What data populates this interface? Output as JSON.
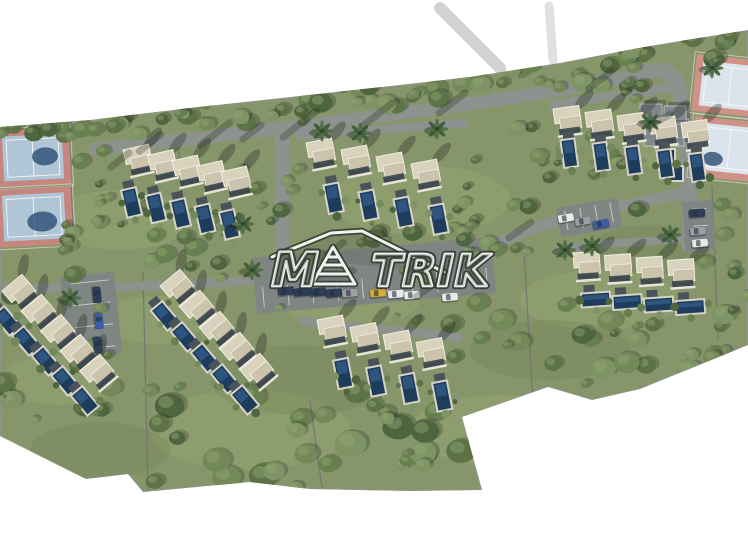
{
  "image": {
    "description": "Aerial 3D architectural rendering (site masterplan) of a residential villa development with private pools, access roads, parking areas and tennis courts, on white background",
    "background": "#ffffff",
    "width": 748,
    "height": 540
  },
  "watermark": {
    "text": "MATRIK",
    "style": "white outlined logo with roof line and striped pyramid as the letter A",
    "render": {
      "left": "M",
      "right": "TRIK"
    }
  },
  "summary": {
    "villas": 32,
    "pools": 34,
    "tennis_courts": 4,
    "parking_lots": 4,
    "cars": 18,
    "palm_trees": 11
  },
  "palette": {
    "grass": "#87966a",
    "grass_light": "#9aa976",
    "grass_dark": "#6e8052",
    "tree_greens": [
      "#5d7347",
      "#68804f",
      "#73895a",
      "#4f6540",
      "#7e9464"
    ],
    "tree_highlight": "#93a771",
    "road": "#8d928e",
    "parking": "#7f8582",
    "plot_line": "#70766e",
    "roof": "#d9d2bc",
    "roof_dark": "#cbc3ac",
    "roof_trim": "#f2efe3",
    "facade": "#39424b",
    "wall": "#e8e5d8",
    "pool": "#1e3c5c",
    "pool_light": "#35608c",
    "deck": "#d7d3c6",
    "patio": "#4a525a",
    "shadow": "rgba(30,38,32,0.32)",
    "tennis_border_west": "#c5867d",
    "tennis_surface_west": "#b0c6d6",
    "tennis_border_east": "#cf9287",
    "tennis_surface_east": "#dbe4ec",
    "tennis_shadow_blob": "#2b4d74",
    "tennis_line": "#f7f7f5",
    "clubhouse_roof": "#82878c",
    "car_colors": {
      "white": "#e9eae8",
      "gray": "#9aa0a3",
      "navy": "#2d3f57",
      "blue": "#3a5fa8",
      "yellow": "#d8ab3a"
    },
    "palm_frond_a": "#3f5c38",
    "palm_frond_b": "#527048",
    "palm_core": "#2e452a"
  },
  "scene": {
    "terrain_outline": [
      [
        0,
        127
      ],
      [
        90,
        120
      ],
      [
        190,
        108
      ],
      [
        300,
        96
      ],
      [
        400,
        85
      ],
      [
        470,
        77
      ],
      [
        560,
        63
      ],
      [
        650,
        46
      ],
      [
        748,
        30
      ],
      [
        748,
        345
      ],
      [
        640,
        389
      ],
      [
        592,
        400
      ],
      [
        548,
        387
      ],
      [
        462,
        417
      ],
      [
        482,
        490
      ],
      [
        410,
        491
      ],
      [
        310,
        489
      ],
      [
        250,
        482
      ],
      [
        143,
        492
      ],
      [
        128,
        474
      ],
      [
        86,
        479
      ],
      [
        0,
        436
      ]
    ],
    "grass_patches": [
      [
        120,
        220,
        70,
        30,
        1
      ],
      [
        420,
        200,
        90,
        35,
        1
      ],
      [
        600,
        300,
        80,
        30,
        1
      ],
      [
        250,
        430,
        100,
        40,
        1
      ],
      [
        500,
        430,
        90,
        35,
        1
      ],
      [
        60,
        380,
        60,
        25,
        1
      ],
      [
        680,
        150,
        50,
        22,
        1
      ],
      [
        350,
        300,
        70,
        26,
        1
      ],
      [
        300,
        380,
        90,
        35,
        0
      ],
      [
        550,
        350,
        80,
        30,
        0
      ],
      [
        100,
        450,
        70,
        28,
        0
      ],
      [
        650,
        250,
        60,
        25,
        0
      ],
      [
        160,
        320,
        60,
        24,
        1
      ]
    ],
    "roads": [
      {
        "name": "road-main",
        "d": "M 95,150 C 200,138 340,122 470,104 C 540,94 600,84 645,72",
        "w": 13
      },
      {
        "name": "road-tennis-east",
        "d": "M 645,72 C 670,66 677,76 680,95 L 687,160 C 690,190 690,210 689,245",
        "w": 15
      },
      {
        "name": "road-east-link",
        "d": "M 688,192 C 645,202 600,208 560,220 C 520,232 488,246 460,262 L 443,272",
        "w": 11
      },
      {
        "name": "road-north-spur",
        "d": "M 282,132 L 282,250",
        "w": 14
      },
      {
        "name": "road-west",
        "d": "M 256,280 C 200,284 120,288 30,288 L 6,288",
        "w": 9
      },
      {
        "name": "lane-cluster-southeast",
        "d": "M 556,250 C 600,244 656,240 708,238",
        "w": 8
      },
      {
        "name": "lane-cluster-south",
        "d": "M 303,321 C 350,327 410,332 458,337",
        "w": 9
      },
      {
        "name": "lane-cluster-north",
        "d": "M 300,136 C 350,132 420,127 464,123",
        "w": 9
      },
      {
        "name": "lane-cluster-northeast",
        "d": "M 553,105 C 610,96 648,91 676,87",
        "w": 9
      }
    ],
    "offsite_roads": [
      {
        "name": "offsite-road-north",
        "d": "M 500,68 L 440,8",
        "w": 12,
        "o": 0.4
      },
      {
        "name": "offsite-road-top",
        "d": "M 553,60 L 549,6",
        "w": 9,
        "o": 0.28
      }
    ],
    "parking_lots": [
      {
        "name": "parking-central",
        "x": 252,
        "y": 258,
        "w": 240,
        "h": 56,
        "rot": -5,
        "ticks": 10,
        "axis": "x"
      },
      {
        "name": "parking-west",
        "x": 60,
        "y": 277,
        "w": 54,
        "h": 82,
        "rot": -6,
        "ticks": 4,
        "axis": "y"
      },
      {
        "name": "parking-east",
        "x": 556,
        "y": 208,
        "w": 62,
        "h": 30,
        "rot": -10,
        "ticks": 4,
        "axis": "x"
      },
      {
        "name": "parking-northeast",
        "x": 682,
        "y": 202,
        "w": 30,
        "h": 50,
        "rot": -4,
        "ticks": 3,
        "axis": "y"
      }
    ],
    "plot_lines": [
      [
        143,
        272,
        148,
        492
      ],
      [
        69,
        131,
        74,
        252
      ],
      [
        310,
        400,
        322,
        488
      ],
      [
        524,
        252,
        533,
        402
      ],
      [
        712,
        186,
        718,
        340
      ],
      [
        178,
        141,
        184,
        212
      ]
    ],
    "tree_belts": [
      [
        0,
        112,
        150,
        26,
        16,
        5,
        10
      ],
      [
        150,
        98,
        160,
        28,
        18,
        5,
        11
      ],
      [
        310,
        80,
        160,
        30,
        18,
        5,
        12
      ],
      [
        470,
        60,
        150,
        30,
        16,
        5,
        11
      ],
      [
        620,
        32,
        128,
        34,
        14,
        5,
        11
      ],
      [
        60,
        128,
        55,
        120,
        10,
        4,
        9
      ],
      [
        150,
        228,
        340,
        52,
        20,
        5,
        11
      ],
      [
        0,
        250,
        150,
        160,
        16,
        5,
        12
      ],
      [
        150,
        390,
        340,
        100,
        30,
        7,
        16
      ],
      [
        430,
        300,
        300,
        85,
        26,
        6,
        13
      ],
      [
        500,
        122,
        160,
        88,
        14,
        4,
        10
      ],
      [
        240,
        150,
        70,
        90,
        8,
        4,
        9
      ],
      [
        450,
        180,
        80,
        70,
        8,
        4,
        9
      ],
      [
        700,
        200,
        48,
        120,
        8,
        4,
        9
      ],
      [
        90,
        185,
        150,
        55,
        10,
        4,
        9
      ],
      [
        0,
        130,
        748,
        340,
        26,
        3,
        6
      ],
      [
        620,
        60,
        34,
        40,
        6,
        4,
        8
      ]
    ],
    "clusters": [
      {
        "name": "cluster-northwest",
        "count": 5,
        "start": [
          123,
          150
        ],
        "dx": 24.5,
        "dy": 5.5,
        "rot": -13,
        "pool_off": [
          -10,
          40
        ],
        "pool_size": [
          13,
          26
        ]
      },
      {
        "name": "cluster-north",
        "count": 4,
        "start": [
          306,
          143
        ],
        "dx": 35,
        "dy": 7,
        "rot": -11,
        "pool_off": [
          10,
          46
        ],
        "pool_size": [
          13,
          27
        ]
      },
      {
        "name": "cluster-northeast",
        "count": 5,
        "start": [
          553,
          109
        ],
        "dx": 32,
        "dy": 3.5,
        "rot": -8,
        "pool_off": [
          4,
          33
        ],
        "pool_size": [
          12,
          26
        ]
      },
      {
        "name": "cluster-west",
        "count": 5,
        "start": [
          2,
          291
        ],
        "dx": 19.5,
        "dy": 20,
        "rot": -40,
        "pool_off": [
          -22,
          14
        ],
        "pool_size": [
          13,
          24
        ]
      },
      {
        "name": "cluster-southwest",
        "count": 5,
        "start": [
          160,
          286
        ],
        "dx": 20,
        "dy": 21,
        "rot": -40,
        "pool_off": [
          -22,
          14
        ],
        "pool_size": [
          13,
          24
        ]
      },
      {
        "name": "cluster-south",
        "count": 4,
        "start": [
          317,
          320
        ],
        "dx": 33,
        "dy": 7.5,
        "rot": -11,
        "pool_off": [
          9,
          44
        ],
        "pool_size": [
          13,
          27
        ]
      },
      {
        "name": "cluster-southeast",
        "count": 4,
        "start": [
          573,
          253
        ],
        "dx": 31.5,
        "dy": 2.5,
        "rot": -4,
        "pool_off": [
          6,
          42
        ],
        "pool_size": [
          27,
          12
        ]
      }
    ],
    "tennis_courts": [
      {
        "name": "tennis-court-west-1",
        "side": "west",
        "rot": -3,
        "cx": 33,
        "cy": 157,
        "border": [
          -4,
          129,
          74,
          57
        ],
        "surface": [
          3,
          135,
          60,
          45
        ],
        "blob": [
          45,
          157,
          13,
          9
        ]
      },
      {
        "name": "tennis-court-west-2",
        "side": "west",
        "rot": -3,
        "cx": 33,
        "cy": 217,
        "border": [
          -4,
          188,
          76,
          58
        ],
        "surface": [
          3,
          194,
          62,
          46
        ],
        "blob": [
          42,
          222,
          15,
          10
        ]
      },
      {
        "name": "tennis-court-east-1",
        "side": "east",
        "rot": 6,
        "cx": 724,
        "cy": 85,
        "border": [
          694,
          57,
          72,
          57
        ],
        "surface": [
          701,
          63,
          58,
          45
        ]
      },
      {
        "name": "tennis-court-east-2",
        "side": "east",
        "rot": 6,
        "cx": 724,
        "cy": 148,
        "border": [
          692,
          119,
          76,
          60
        ],
        "surface": [
          699,
          125,
          60,
          47
        ],
        "blob": [
          714,
          160,
          10,
          7
        ]
      }
    ],
    "clubhouse": {
      "buildings": [
        [
          640,
          104,
          22,
          16
        ],
        [
          664,
          106,
          22,
          16
        ],
        [
          644,
          124,
          40,
          22
        ]
      ],
      "pools": [
        [
          662,
          150,
          12,
          14
        ],
        [
          668,
          167,
          14,
          13
        ]
      ]
    },
    "palms": [
      [
        322,
        131
      ],
      [
        360,
        133
      ],
      [
        437,
        129
      ],
      [
        243,
        224
      ],
      [
        252,
        270
      ],
      [
        70,
        298
      ],
      [
        592,
        246
      ],
      [
        670,
        235
      ],
      [
        650,
        122
      ],
      [
        712,
        68
      ],
      [
        565,
        250
      ]
    ],
    "cars": [
      [
        286,
        291,
        -5,
        "navy"
      ],
      [
        302,
        292,
        -5,
        "navy"
      ],
      [
        318,
        292,
        -5,
        "navy"
      ],
      [
        334,
        293,
        -5,
        "navy"
      ],
      [
        350,
        293,
        -5,
        "gray"
      ],
      [
        378,
        293,
        -5,
        "yellow"
      ],
      [
        396,
        294,
        -5,
        "white"
      ],
      [
        412,
        295,
        -5,
        "white"
      ],
      [
        450,
        297,
        -5,
        "white"
      ],
      [
        97,
        295,
        84,
        "navy"
      ],
      [
        99,
        321,
        84,
        "blue"
      ],
      [
        98,
        345,
        84,
        "navy"
      ],
      [
        566,
        218,
        -10,
        "white"
      ],
      [
        583,
        221,
        -10,
        "gray"
      ],
      [
        601,
        224,
        -10,
        "blue"
      ],
      [
        697,
        213,
        -5,
        "navy"
      ],
      [
        698,
        231,
        -5,
        "gray"
      ],
      [
        700,
        243,
        -5,
        "white"
      ]
    ],
    "shadow_streaks": [
      [
        150,
        143,
        34,
        -38
      ],
      [
        215,
        134,
        44,
        -38
      ],
      [
        300,
        124,
        50,
        -38
      ],
      [
        378,
        114,
        44,
        -38
      ],
      [
        452,
        103,
        40,
        -38
      ],
      [
        252,
        132,
        30,
        -38
      ],
      [
        600,
        80,
        36,
        -38
      ],
      [
        660,
        120,
        30,
        -30
      ],
      [
        330,
        252,
        40,
        -35
      ],
      [
        430,
        287,
        40,
        -35
      ],
      [
        120,
        160,
        30,
        -38
      ],
      [
        520,
        230,
        34,
        -35
      ]
    ]
  }
}
